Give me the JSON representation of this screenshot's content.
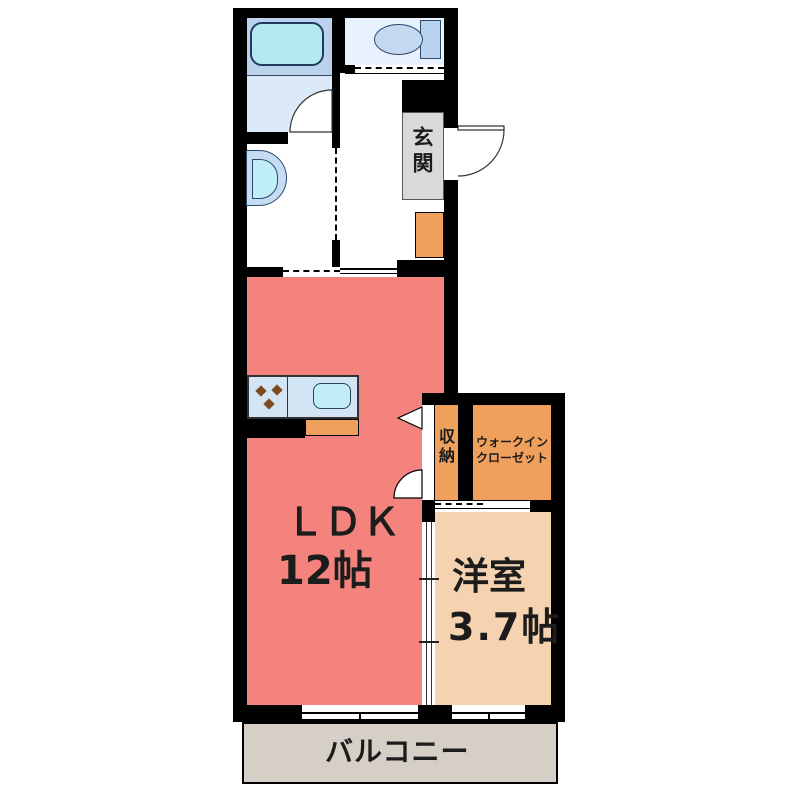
{
  "plan_title": "apartment-floor-plan",
  "rooms": {
    "ldk": {
      "name": "ＬＤＫ",
      "size": "12帖",
      "color": "#f4837e"
    },
    "western_room": {
      "name": "洋室",
      "size": "3.7帖",
      "color": "#f5d3b1"
    },
    "storage": {
      "name": "収納",
      "color": "#efa05c"
    },
    "walk_in_closet": {
      "name": "ウォークインクローゼット",
      "color": "#efa05c"
    },
    "entrance": {
      "name": "玄関",
      "color": "#d9d9d9"
    },
    "balcony": {
      "name": "バルコニー",
      "color": "#d6cfc7"
    }
  },
  "colors": {
    "wall": "#000000",
    "bath_room": "#bcd2ec",
    "bathtub": "#b5e9f2",
    "changing_room": "#dbe9f9",
    "toilet_room": "#e8f1fd",
    "fixture_blue": "#c4d9f1",
    "kitchen_counter": "#d3e4f4",
    "kitchen_sink": "#c2edf7",
    "counter_orange": "#efa05c",
    "stove_dot": "#7a4a22"
  }
}
